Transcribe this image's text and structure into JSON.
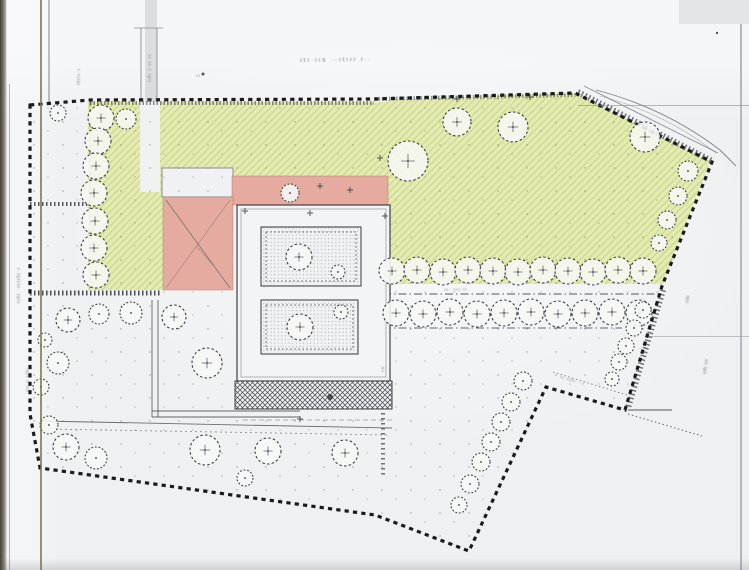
{
  "page": {
    "width": 749,
    "height": 570
  },
  "colors": {
    "paper": "#f0f1f3",
    "green": "#e4ebae",
    "green_hatch": "rgba(113,122,58,0.24)",
    "pink": "#e5aba0",
    "pink_edge": "rgba(158,104,92,0.55)",
    "boundary": "#1a1b1d",
    "line": "#3d4145",
    "tree_stroke": "#3c3f42",
    "tree_fill": "rgba(247,248,246,0.88)"
  },
  "plan": {
    "boundary": [
      [
        30,
        105
      ],
      [
        90,
        100
      ],
      [
        375,
        99
      ],
      [
        575,
        93
      ],
      [
        712,
        162
      ],
      [
        662,
        286
      ],
      [
        625,
        410
      ],
      [
        546,
        387
      ],
      [
        469,
        551
      ],
      [
        375,
        515
      ],
      [
        40,
        468
      ],
      [
        30,
        414
      ]
    ],
    "green_areas": [
      [
        [
          88,
          102
        ],
        [
          234,
          102
        ],
        [
          234,
          197
        ],
        [
          163,
          197
        ],
        [
          163,
          290
        ],
        [
          88,
          290
        ]
      ],
      [
        [
          234,
          102
        ],
        [
          390,
          102
        ],
        [
          390,
          177
        ],
        [
          234,
          177
        ]
      ],
      [
        [
          388,
          100
        ],
        [
          575,
          93
        ],
        [
          710,
          161
        ],
        [
          663,
          284
        ],
        [
          388,
          284
        ]
      ]
    ],
    "paper_cutouts": [
      {
        "x": 140,
        "y": 102,
        "w": 20,
        "h": 90,
        "stroke": false
      },
      {
        "x": 162,
        "y": 168,
        "w": 71,
        "h": 29,
        "stroke": true
      }
    ],
    "pink_areas": [
      {
        "x": 232,
        "y": 176,
        "w": 156,
        "h": 29
      },
      {
        "x": 163,
        "y": 197,
        "w": 70,
        "h": 93
      }
    ],
    "pink_roof_lines": [
      {
        "p": [
          166,
          200,
          230,
          288
        ],
        "w": 0.9,
        "o": 0.8
      },
      {
        "p": [
          230,
          200,
          166,
          288
        ],
        "w": 0.7,
        "o": 0.5
      },
      {
        "p": [
          196,
          246,
          214,
          266
        ],
        "w": 0.7,
        "o": 0.5
      }
    ],
    "building": {
      "base": [
        237,
        205,
        153,
        176
      ],
      "base_inner": [
        241,
        209,
        145,
        168
      ],
      "wings": [
        [
          261,
          227,
          100,
          59
        ],
        [
          261,
          300,
          97,
          54
        ]
      ],
      "crosshatch": [
        235,
        381,
        157,
        28
      ]
    },
    "lines": [
      {
        "p": [
          90,
          102,
          90,
          290
        ],
        "w": 1,
        "d": "4 3",
        "c": "#565a5e",
        "o": 0.8
      },
      {
        "p": [
          90,
          103,
          374,
          103
        ],
        "w": 4,
        "d": "1.5 2",
        "c": "#34373b",
        "o": 0.55
      },
      {
        "p": [
          375,
          99,
          575,
          95
        ],
        "w": 4,
        "d": "1.5 2",
        "c": "#34373b",
        "o": 0.5
      },
      {
        "p": [
          30,
          293,
          162,
          293
        ],
        "w": 5,
        "d": "1.5 2.5",
        "c": "#303337",
        "o": 0.85
      },
      {
        "p": [
          30,
          204,
          88,
          204
        ],
        "w": 4,
        "d": "1.5 2.5",
        "c": "#303337",
        "o": 0.8
      },
      {
        "p": [
          578,
          92,
          712,
          161
        ],
        "w": 6,
        "d": "1.5 2.5",
        "c": "#3a3d41",
        "o": 0.7
      },
      {
        "p": [
          663,
          290,
          628,
          408
        ],
        "w": 6,
        "d": "1.5 2.5",
        "c": "#3a3d41",
        "o": 0.7
      },
      {
        "p": [
          584,
          86,
          718,
          153
        ],
        "w": 0.8,
        "d": null,
        "c": "#6a6f74",
        "o": 0.8
      },
      {
        "p": [
          383,
          294,
          662,
          294
        ],
        "w": 1,
        "d": "8 3 1.5 3",
        "c": "#44484c",
        "o": 0.9
      },
      {
        "p": [
          383,
          328,
          622,
          328
        ],
        "w": 1,
        "d": "8 3 1.5 3",
        "c": "#44484c",
        "o": 0.8
      },
      {
        "p": [
          383,
          283,
          383,
          478
        ],
        "w": 4,
        "d": "1.5 3.5",
        "c": "#44484c",
        "o": 0.75
      },
      {
        "p": [
          628,
          410,
          672,
          410
        ],
        "w": 1,
        "d": null,
        "c": "#44484c",
        "o": 0.9
      },
      {
        "p": [
          628,
          414,
          702,
          436
        ],
        "w": 1,
        "d": "1.5 2.5",
        "c": "#505459",
        "o": 0.85
      },
      {
        "p": [
          553,
          372,
          630,
          396
        ],
        "w": 0.8,
        "d": "1.5 2.5",
        "c": "#505459",
        "o": 0.8
      },
      {
        "p": [
          141,
          28,
          141,
          102
        ],
        "w": 0.8,
        "d": null,
        "c": "#6d7277",
        "o": 0.9
      },
      {
        "p": [
          157,
          28,
          157,
          102
        ],
        "w": 0.8,
        "d": null,
        "c": "#6d7277",
        "o": 0.9
      },
      {
        "p": [
          134,
          28,
          163,
          28
        ],
        "w": 0.8,
        "d": null,
        "c": "#6d7277",
        "o": 0.8
      },
      {
        "p": [
          49,
          0,
          49,
          102
        ],
        "w": 0.9,
        "d": null,
        "c": "#5d6166",
        "o": 0.85
      },
      {
        "p": [
          152,
          300,
          152,
          417
        ],
        "w": 0.9,
        "d": null,
        "c": "#54585c",
        "o": 0.9
      },
      {
        "p": [
          158,
          300,
          158,
          417
        ],
        "w": 0.9,
        "d": null,
        "c": "#54585c",
        "o": 0.9
      },
      {
        "p": [
          152,
          411,
          300,
          411
        ],
        "w": 0.9,
        "d": null,
        "c": "#54585c",
        "o": 0.9
      },
      {
        "p": [
          152,
          417,
          300,
          417
        ],
        "w": 0.9,
        "d": null,
        "c": "#54585c",
        "o": 0.9
      },
      {
        "p": [
          40,
          421,
          392,
          428
        ],
        "w": 0.9,
        "d": null,
        "c": "#54585c",
        "o": 0.85
      },
      {
        "p": [
          45,
          429,
          390,
          435
        ],
        "w": 0.9,
        "d": "2 3",
        "c": "#64686d",
        "o": 0.7
      },
      {
        "p": [
          243,
          420,
          392,
          420
        ],
        "w": 0.8,
        "d": "5 3",
        "c": "#64686d",
        "o": 0.6
      },
      {
        "p": [
          261,
          293,
          358,
          293
        ],
        "w": 0.7,
        "d": null,
        "c": "#8a8e93",
        "o": 0.7
      }
    ],
    "curves": [
      {
        "d": "M596,90 Q665,108 720,150 L736,166",
        "w": 0.9,
        "o": 0.85
      },
      {
        "d": "M600,96 Q665,113 716,153",
        "w": 0.6,
        "o": 0.55
      }
    ],
    "trees": [
      [
        101,
        118,
        13
      ],
      [
        98,
        141,
        13
      ],
      [
        96,
        166,
        13
      ],
      [
        94,
        193,
        13
      ],
      [
        95,
        221,
        13
      ],
      [
        94,
        248,
        13
      ],
      [
        96,
        275,
        13
      ],
      [
        58,
        113,
        8
      ],
      [
        126,
        119,
        10
      ],
      [
        68,
        320,
        12
      ],
      [
        45,
        340,
        7
      ],
      [
        58,
        363,
        11
      ],
      [
        41,
        387,
        8
      ],
      [
        99,
        314,
        10
      ],
      [
        131,
        313,
        11
      ],
      [
        174,
        317,
        12
      ],
      [
        207,
        363,
        15
      ],
      [
        49,
        425,
        9
      ],
      [
        66,
        447,
        13
      ],
      [
        96,
        458,
        11
      ],
      [
        205,
        450,
        15
      ],
      [
        268,
        451,
        13
      ],
      [
        345,
        453,
        13
      ],
      [
        245,
        478,
        8
      ],
      [
        457,
        122,
        14
      ],
      [
        513,
        127,
        15
      ],
      [
        645,
        137,
        15
      ],
      [
        408,
        161,
        20
      ],
      [
        688,
        171,
        10
      ],
      [
        678,
        196,
        9
      ],
      [
        667,
        220,
        9
      ],
      [
        659,
        243,
        8
      ],
      [
        392,
        271,
        13
      ],
      [
        417,
        270,
        13
      ],
      [
        443,
        272,
        13
      ],
      [
        468,
        270,
        13
      ],
      [
        493,
        271,
        13
      ],
      [
        518,
        272,
        13
      ],
      [
        543,
        270,
        13
      ],
      [
        568,
        271,
        13
      ],
      [
        593,
        272,
        13
      ],
      [
        618,
        270,
        13
      ],
      [
        643,
        271,
        13
      ],
      [
        396,
        313,
        13
      ],
      [
        423,
        314,
        13
      ],
      [
        450,
        312,
        13
      ],
      [
        477,
        314,
        13
      ],
      [
        504,
        313,
        13
      ],
      [
        531,
        312,
        13
      ],
      [
        558,
        314,
        13
      ],
      [
        585,
        313,
        13
      ],
      [
        612,
        312,
        13
      ],
      [
        639,
        313,
        13
      ],
      [
        643,
        310,
        8
      ],
      [
        634,
        328,
        8
      ],
      [
        626,
        346,
        8
      ],
      [
        619,
        362,
        8
      ],
      [
        612,
        379,
        7
      ],
      [
        523,
        381,
        9
      ],
      [
        511,
        402,
        9
      ],
      [
        501,
        422,
        9
      ],
      [
        491,
        442,
        9
      ],
      [
        481,
        462,
        9
      ],
      [
        470,
        484,
        9
      ],
      [
        459,
        505,
        8
      ],
      [
        299,
        257,
        13
      ],
      [
        338,
        272,
        7
      ],
      [
        300,
        327,
        13
      ],
      [
        341,
        312,
        7
      ],
      [
        290,
        193,
        9
      ]
    ],
    "crosses": [
      [
        245,
        211
      ],
      [
        310,
        213
      ],
      [
        320,
        186
      ],
      [
        350,
        190
      ],
      [
        385,
        216
      ],
      [
        300,
        419
      ],
      [
        380,
        158
      ],
      [
        530,
        97
      ],
      [
        457,
        99
      ]
    ],
    "blobs": [
      [
        330,
        397,
        3
      ],
      [
        203,
        74,
        1.5
      ],
      [
        717,
        33,
        1.2
      ]
    ]
  },
  "labels": [
    {
      "id": "road-label-top",
      "x": 300,
      "y": 62,
      "rot": -1,
      "size": 6,
      "ls": 2,
      "text": "ıtı·ııs ··ıtııı ı··"
    },
    {
      "id": "street-label-left-upper",
      "x": 20,
      "y": 303,
      "rot": -90,
      "size": 5.5,
      "ls": 1,
      "text": "ııtı ·ııııtı·ı"
    },
    {
      "id": "street-label-left-lower",
      "x": 29,
      "y": 392,
      "rot": -90,
      "size": 5,
      "ls": 1,
      "text": "ııı·ı ııtı"
    },
    {
      "id": "road-label-left",
      "x": 80,
      "y": 85,
      "rot": -90,
      "size": 5,
      "ls": 1,
      "text": "ıtııı·ı"
    },
    {
      "id": "road-label-mid",
      "x": 151,
      "y": 82,
      "rot": -90,
      "size": 5,
      "ls": 1,
      "text": "ııłı ı·ıı ıı"
    },
    {
      "id": "street-label-right-upper",
      "x": 688,
      "y": 305,
      "rot": -80,
      "size": 5,
      "ls": 0.5,
      "text": "·ııtı"
    },
    {
      "id": "street-label-right-lower",
      "x": 706,
      "y": 374,
      "rot": -82,
      "size": 5,
      "ls": 0.5,
      "text": "ııtı ııı"
    },
    {
      "id": "terrace-note",
      "x": 560,
      "y": 378,
      "rot": 17,
      "size": 4.5,
      "ls": 1,
      "text": "ıı·ııtı ··ı"
    },
    {
      "id": "alignment-note",
      "x": 442,
      "y": 291,
      "rot": -1,
      "size": 4.5,
      "ls": 1,
      "text": "·ıı··ııı·ıı"
    },
    {
      "id": "corner-note",
      "x": 196,
      "y": 77,
      "rot": 0,
      "size": 4.5,
      "ls": 0,
      "text": "ı·ı"
    },
    {
      "id": "dim-note-right",
      "x": 384,
      "y": 372,
      "rot": -90,
      "size": 4.5,
      "ls": 0,
      "text": "ı·ıı"
    }
  ]
}
